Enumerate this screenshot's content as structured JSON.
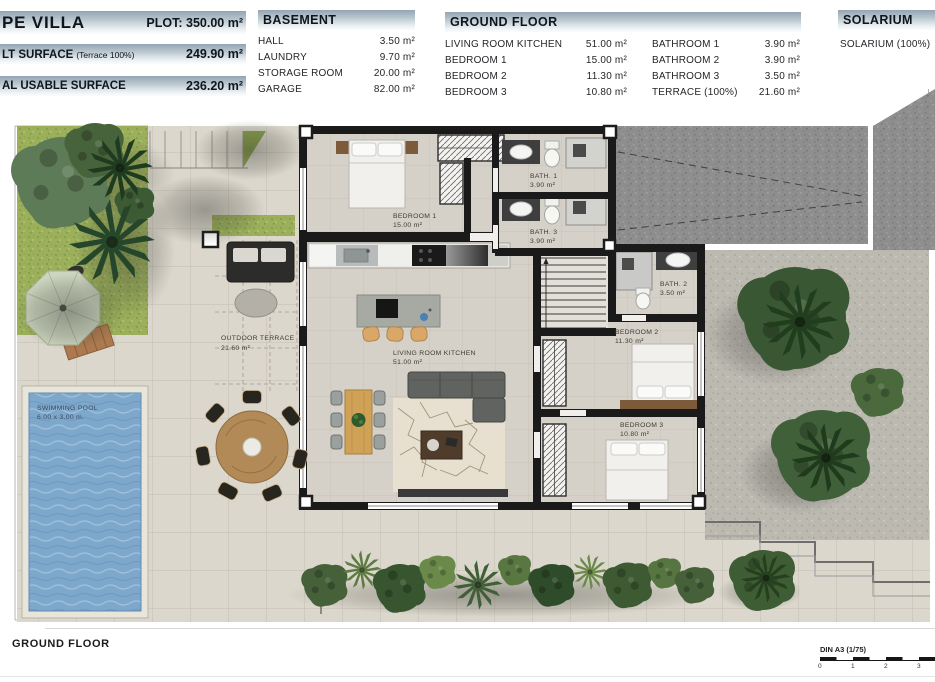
{
  "title_block": {
    "title": "PE VILLA",
    "plot": "PLOT: 350.00 m²",
    "built_label": "LT SURFACE",
    "built_note": "(Terrace 100%)",
    "built_value": "249.90 m²",
    "usable_label": "AL USABLE SURFACE",
    "usable_value": "236.20 m²"
  },
  "basement": {
    "title": "BASEMENT",
    "rows": [
      {
        "label": "HALL",
        "value": "3.50 m²"
      },
      {
        "label": "LAUNDRY",
        "value": "9.70 m²"
      },
      {
        "label": "STORAGE ROOM",
        "value": "20.00 m²"
      },
      {
        "label": "GARAGE",
        "value": "82.00 m²"
      }
    ]
  },
  "ground_floor": {
    "title": "GROUND FLOOR",
    "left_rows": [
      {
        "label": "LIVING ROOM KITCHEN",
        "value": "51.00 m²"
      },
      {
        "label": "BEDROOM 1",
        "value": "15.00 m²"
      },
      {
        "label": "BEDROOM 2",
        "value": "11.30 m²"
      },
      {
        "label": "BEDROOM 3",
        "value": "10.80 m²"
      }
    ],
    "right_rows": [
      {
        "label": "BATHROOM 1",
        "value": "3.90 m²"
      },
      {
        "label": "BATHROOM 2",
        "value": "3.90 m²"
      },
      {
        "label": "BATHROOM 3",
        "value": "3.50 m²"
      },
      {
        "label": "TERRACE (100%)",
        "value": "21.60 m²"
      }
    ]
  },
  "solarium": {
    "title": "SOLARIUM",
    "row_label": "SOLARIUM (100%)"
  },
  "plan": {
    "rooms": {
      "bedroom1": {
        "name": "BEDROOM 1",
        "area": "15.00 m²"
      },
      "bath1": {
        "name": "BATH. 1",
        "area": "3.90 m²"
      },
      "bath3": {
        "name": "BATH. 3",
        "area": "3.90 m²"
      },
      "bath2": {
        "name": "BATH. 2",
        "area": "3.50 m²"
      },
      "bedroom2": {
        "name": "BEDROOM 2",
        "area": "11.30 m²"
      },
      "bedroom3": {
        "name": "BEDROOM 3",
        "area": "10.80 m²"
      },
      "living": {
        "name": "LIVING ROOM KITCHEN",
        "area": "51.00 m²"
      },
      "terrace": {
        "name": "OUTDOOR TERRACE",
        "area": "21.60 m²"
      }
    },
    "pool": {
      "name": "SWIMMING POOL",
      "size": "6.00 x 3.00 m."
    }
  },
  "footer": {
    "floor_label": "GROUND FLOOR",
    "scale_label": "DIN A3 (1/75)",
    "ticks": [
      "0",
      "1",
      "2",
      "3"
    ]
  },
  "colors": {
    "header_bar_top": "#93a4b1",
    "wall": "#1a1a1a",
    "floor": "#d5d1c8",
    "pavement": "#dbd7cc",
    "grass": "#9cb05c",
    "pool_water": "#7ea8cb",
    "driveway": "#8e8e8e",
    "gravel": "#bcb9b1"
  }
}
